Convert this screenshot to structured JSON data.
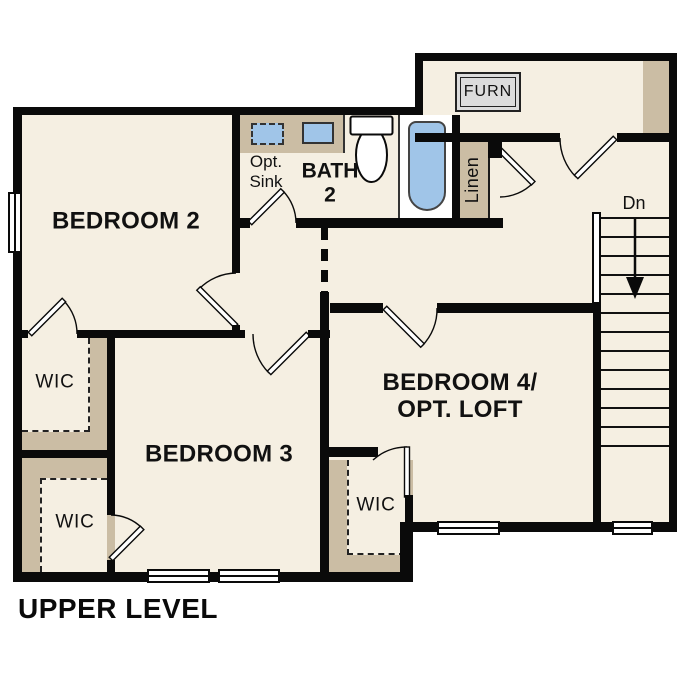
{
  "title": "UPPER LEVEL",
  "plan_type": "floor-plan",
  "labels": {
    "bedroom2": "BEDROOM 2",
    "bedroom3": "BEDROOM 3",
    "bedroom4_line1": "BEDROOM 4/",
    "bedroom4_line2": "OPT. LOFT",
    "bath_line1": "BATH",
    "bath_line2": "2",
    "opt_sink_line1": "Opt.",
    "opt_sink_line2": "Sink",
    "wic": "WIC",
    "linen": "Linen",
    "furnace": "FURN",
    "stairs_down": "Dn"
  },
  "colors": {
    "background": "#ffffff",
    "room_fill": "#f5efe2",
    "closet_tan": "#cbbda4",
    "fixture_blue": "#a0c5e8",
    "wall_black": "#0a0a0a",
    "furnace_gray": "#dcdcdc",
    "text": "#111111"
  }
}
